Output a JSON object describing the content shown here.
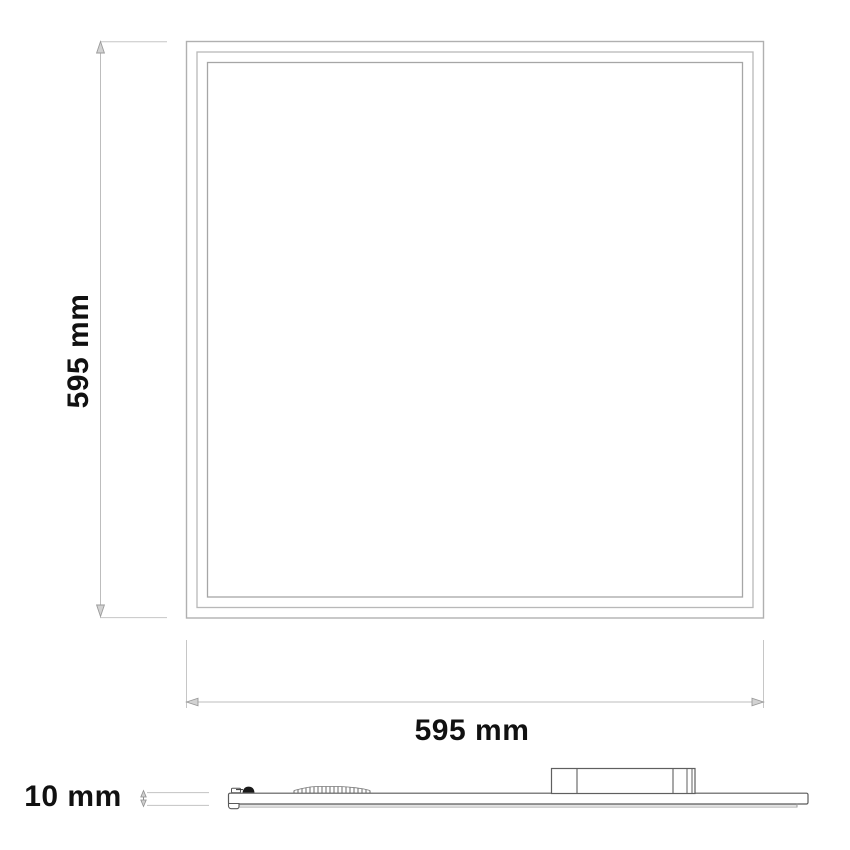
{
  "diagram": {
    "front_view": {
      "height_label": "595 mm",
      "width_label": "595 mm"
    },
    "side_view": {
      "thickness_label": "10 mm"
    },
    "colors": {
      "background": "#ffffff",
      "label_text": "#111111",
      "panel_outline": "#adadad",
      "dimension_line": "#bdbdbd",
      "profile_outline": "#5a5a5a",
      "clip_fill": "#1a1a1a"
    }
  }
}
